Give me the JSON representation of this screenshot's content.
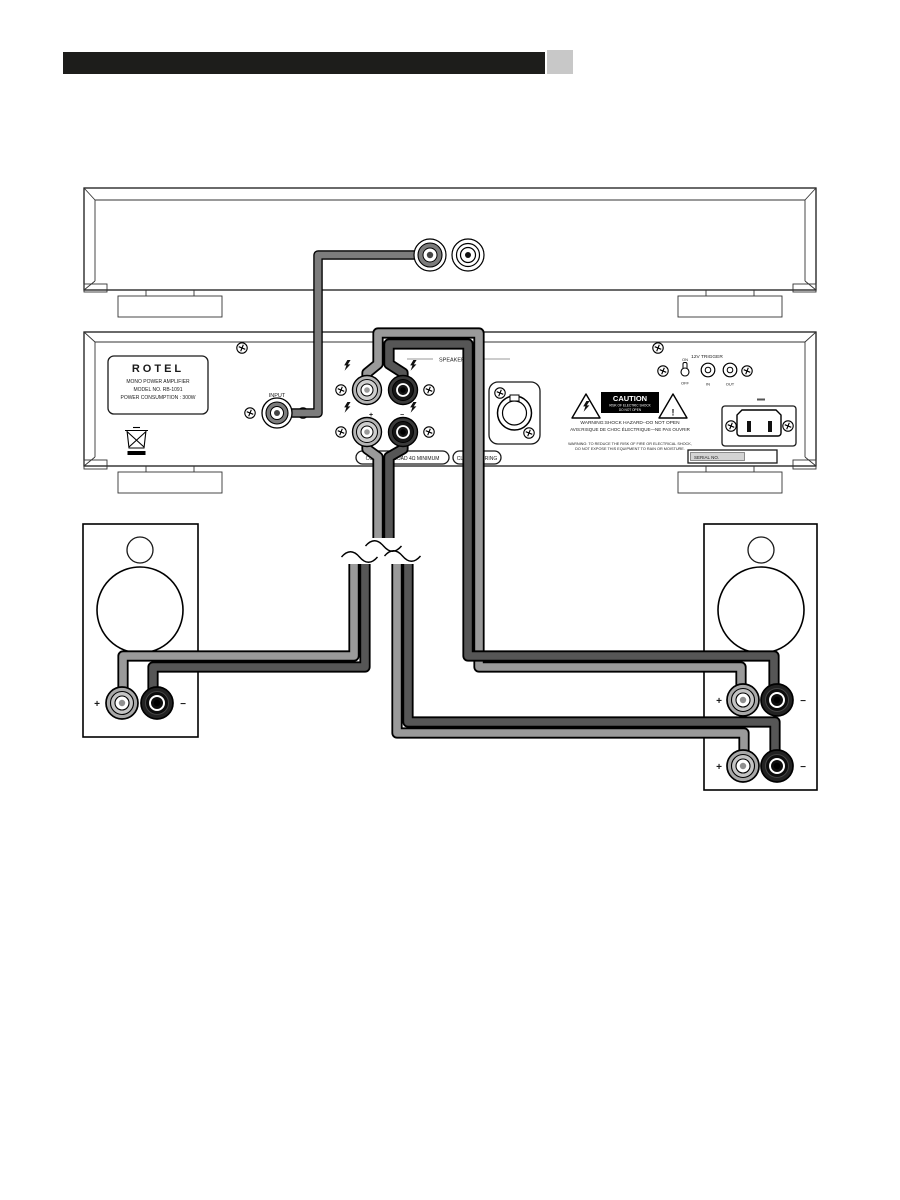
{
  "colors": {
    "header_bar": "#1d1d1b",
    "header_block": "#c8c8c8",
    "cable_light": "#9a9a9a",
    "cable_dark": "#565656",
    "cable_input": "#7c7c7c"
  },
  "amp": {
    "badge": {
      "brand": "ROTEL",
      "line1": "MONO POWER AMPLIFIER",
      "line2": "MODEL NO. RB-1091",
      "line3": "POWER CONSUMPTION : 300W"
    },
    "input_label": "INPUT",
    "speaker_label": "SPEAKER",
    "plus": "+",
    "minus": "−",
    "combined_load": "COMBINED LOAD 4Ω MINIMUM",
    "class_wiring": "CLASS 2 WIRING",
    "serial_label": "SERIAL NO.",
    "trigger": {
      "title": "12V TRIGGER",
      "on": "ON",
      "off": "OFF",
      "in_label": "IN",
      "out_label": "OUT"
    },
    "caution": {
      "title": "CAUTION",
      "risk": "RISK OF ELECTRIC SHOCK",
      "open": "DO NOT OPEN",
      "exclamation": "!",
      "warning_line": "WARNING:SHOCK HAZARD--DO NOT OPEN",
      "avis_line": "AVIS:RISQUE DE CHOC ÉLECTRIQUE—NE PAS OUVRIR",
      "fire_line1": "WARNING: TO REDUCE THE RISK OF FIRE OR ELECTRICAL SHOCK,",
      "fire_line2": "DO NOT EXPOSE THIS EQUIPMENT TO RAIN OR MOISTURE."
    }
  },
  "left_speaker": {
    "plus": "+",
    "minus": "−"
  },
  "right_speaker": {
    "plus": "+",
    "minus": "−"
  }
}
